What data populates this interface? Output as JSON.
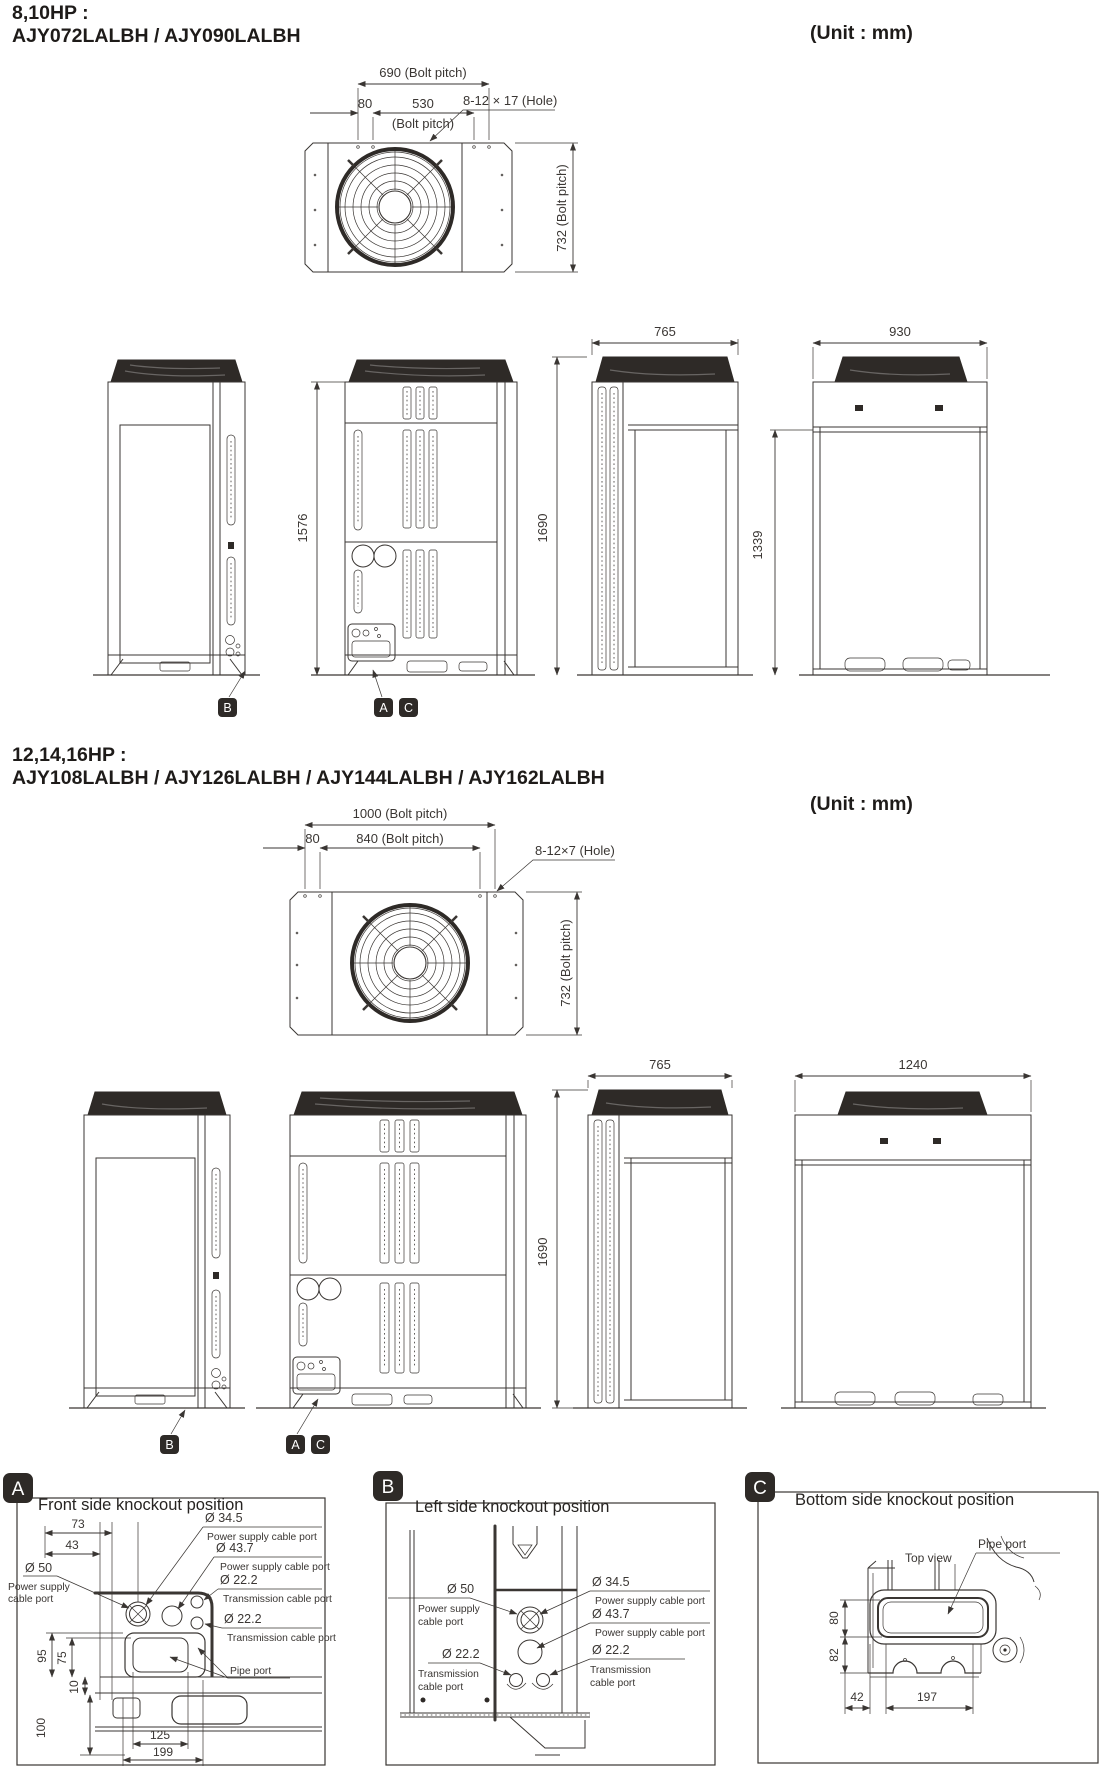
{
  "section1": {
    "hp_line": "8,10HP :",
    "model_line": "AJY072LALBH / AJY090LALBH",
    "unit_label": "(Unit : mm)",
    "top": {
      "bolt_pitch_w": "690 (Bolt pitch)",
      "offset": "80",
      "bolt_pitch_inner": "530",
      "bolt_pitch_inner_sub": "(Bolt pitch)",
      "hole": "8-12 × 17 (Hole)",
      "bolt_pitch_d": "732 (Bolt pitch)"
    },
    "elev": {
      "h_cabinet": "1576",
      "depth": "765",
      "h_total": "1690",
      "h_grille": "1339",
      "width": "930"
    },
    "badge_a": "A",
    "badge_b": "B",
    "badge_c": "C"
  },
  "section2": {
    "hp_line": "12,14,16HP :",
    "model_line": "AJY108LALBH / AJY126LALBH / AJY144LALBH / AJY162LALBH",
    "unit_label": "(Unit : mm)",
    "top": {
      "bolt_pitch_w": "1000 (Bolt pitch)",
      "offset": "80",
      "bolt_pitch_inner": "840 (Bolt pitch)",
      "hole": "8-12×7 (Hole)",
      "bolt_pitch_d": "732 (Bolt pitch)"
    },
    "elev": {
      "depth": "765",
      "h_total": "1690",
      "width": "1240"
    },
    "badge_a": "A",
    "badge_b": "B",
    "badge_c": "C"
  },
  "panel_a": {
    "badge": "A",
    "title": "Front side knockout position",
    "d73": "73",
    "d43": "43",
    "dia50": "Ø 50",
    "dia50_l1": "Power supply",
    "dia50_l2": "cable port",
    "dia345": "Ø 34.5",
    "dia345_l": "Power supply cable port",
    "dia437": "Ø 43.7",
    "dia437_l": "Power supply cable port",
    "dia222a": "Ø 22.2",
    "dia222a_l": "Transmission cable  port",
    "dia222b": "Ø 22.2",
    "dia222b_l": "Transmission cable  port",
    "pipe_port": "Pipe port",
    "d95": "95",
    "d75": "75",
    "d10": "10",
    "d100": "100",
    "d125": "125",
    "d199": "199"
  },
  "panel_b": {
    "badge": "B",
    "title": "Left side knockout position",
    "dia50": "Ø 50",
    "dia50_l1": "Power supply",
    "dia50_l2": "cable port",
    "dia345": "Ø 34.5",
    "dia345_l": "Power supply cable port",
    "dia437": "Ø 43.7",
    "dia437_l": "Power supply cable port",
    "dia222a": "Ø 22.2",
    "dia222a_l1": "Transmission",
    "dia222a_l2": "cable  port",
    "dia222b": "Ø 22.2",
    "dia222b_l1": "Transmission",
    "dia222b_l2": "cable  port"
  },
  "panel_c": {
    "badge": "C",
    "title": "Bottom side knockout position",
    "top_view": "Top view",
    "pipe_port": "Pipe port",
    "d80": "80",
    "d82": "82",
    "d42": "42",
    "d197": "197"
  },
  "colors": {
    "ink": "#3a3633",
    "dark_fill": "#2e2a27"
  }
}
